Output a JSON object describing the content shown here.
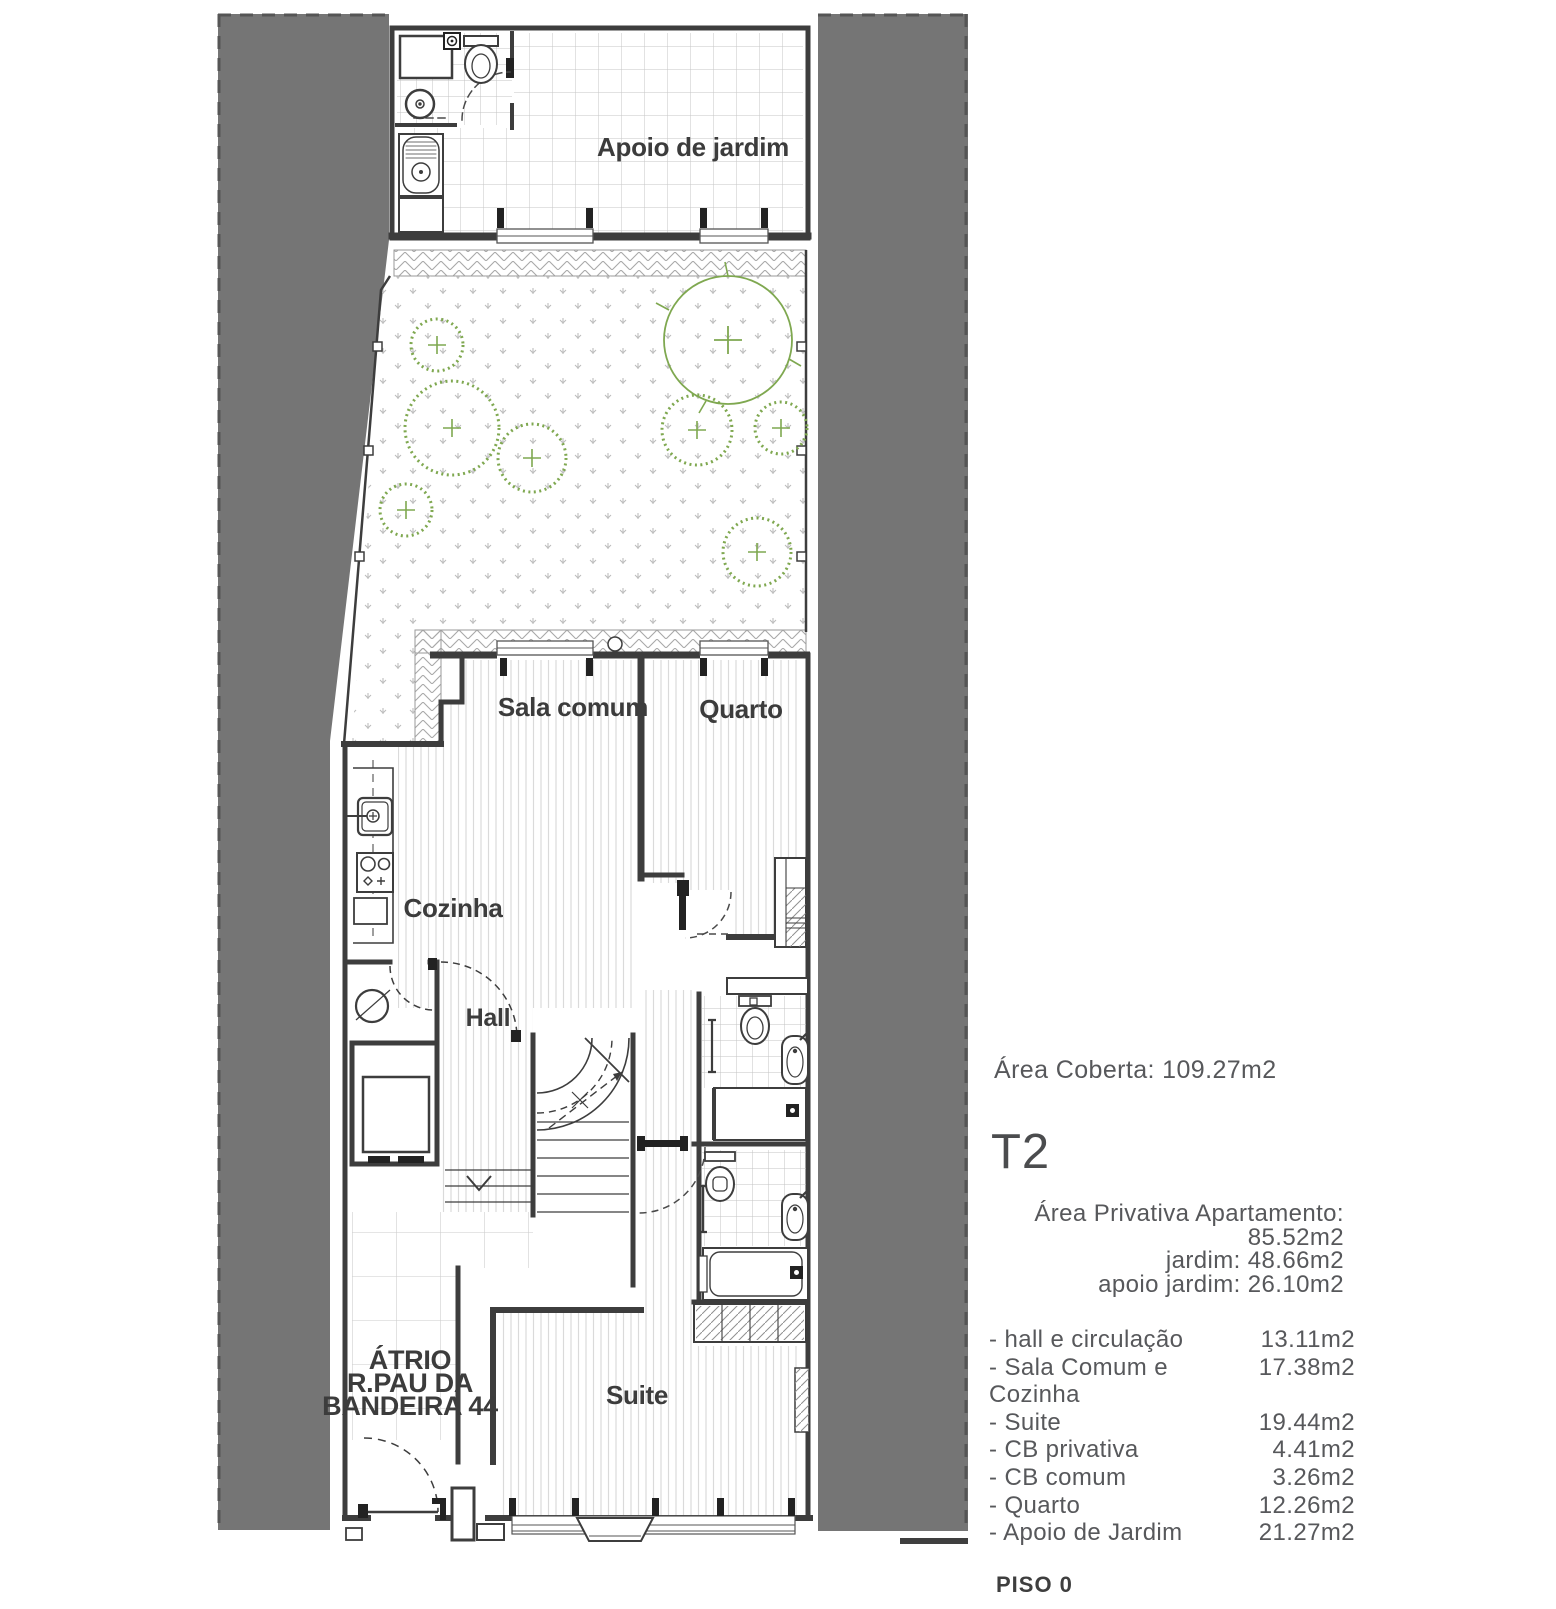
{
  "plan": {
    "labels": {
      "apoio_jardim": "Apoio de jardim",
      "sala_comum": "Sala comum",
      "quarto": "Quarto",
      "cozinha": "Cozinha",
      "hall": "Hall",
      "atrio_line1": "ÁTRIO",
      "atrio_line2": "R.PAU DA",
      "atrio_line3": "BANDEIRA 44",
      "suite": "Suite"
    },
    "colors": {
      "neighbor_gray": "#757575",
      "wall_line": "#3d3d3d",
      "tree_green": "#7fa850",
      "floor_line": "#dadada",
      "tile_line": "#c6c6c6",
      "hatch_line": "#a9a9a9",
      "plan_text": "#3c3c3c",
      "panel_text": "#57585b"
    }
  },
  "info_panel": {
    "area_coberta": "Área Coberta: 109.27m2",
    "unit_type": "T2",
    "private_areas": [
      "Área Privativa Apartamento: 85.52m2",
      "jardim: 48.66m2",
      "apoio jardim:  26.10m2"
    ],
    "room_areas": [
      {
        "label": "- hall e circulação",
        "value": "13.11m2"
      },
      {
        "label": "- Sala Comum e Cozinha",
        "value": "17.38m2"
      },
      {
        "label": "- Suite",
        "value": "19.44m2"
      },
      {
        "label": "- CB privativa",
        "value": "4.41m2"
      },
      {
        "label": "- CB comum",
        "value": "3.26m2"
      },
      {
        "label": "- Quarto",
        "value": "12.26m2"
      },
      {
        "label": "- Apoio de Jardim",
        "value": "21.27m2"
      }
    ],
    "floor_label": "PISO 0"
  }
}
